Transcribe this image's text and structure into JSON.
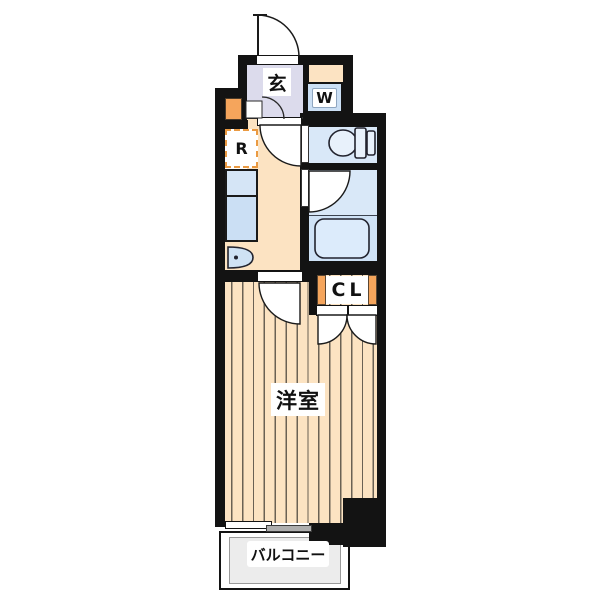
{
  "plan": {
    "entrance_label": "玄",
    "washer_label": "W",
    "refrigerator_label": "R",
    "closet_label": "CL",
    "main_room_label": "洋室",
    "balcony_label": "バルコニー"
  },
  "colors": {
    "wall": "#131313",
    "floor": "#fce3c2",
    "floor_stripe": "#6a6154",
    "genkan": "#dcdbec",
    "water": "#d9e8f8",
    "water_dark": "#cfe2f6",
    "fixture": "#e8f1fb",
    "counter": "#cbdff4",
    "counter_light": "#d5e5f6",
    "accent_orange": "#f5a55c",
    "accent_orange2": "#ea9a42",
    "balcony_fill": "#ececec",
    "pane_gray": "#aeaeae"
  }
}
